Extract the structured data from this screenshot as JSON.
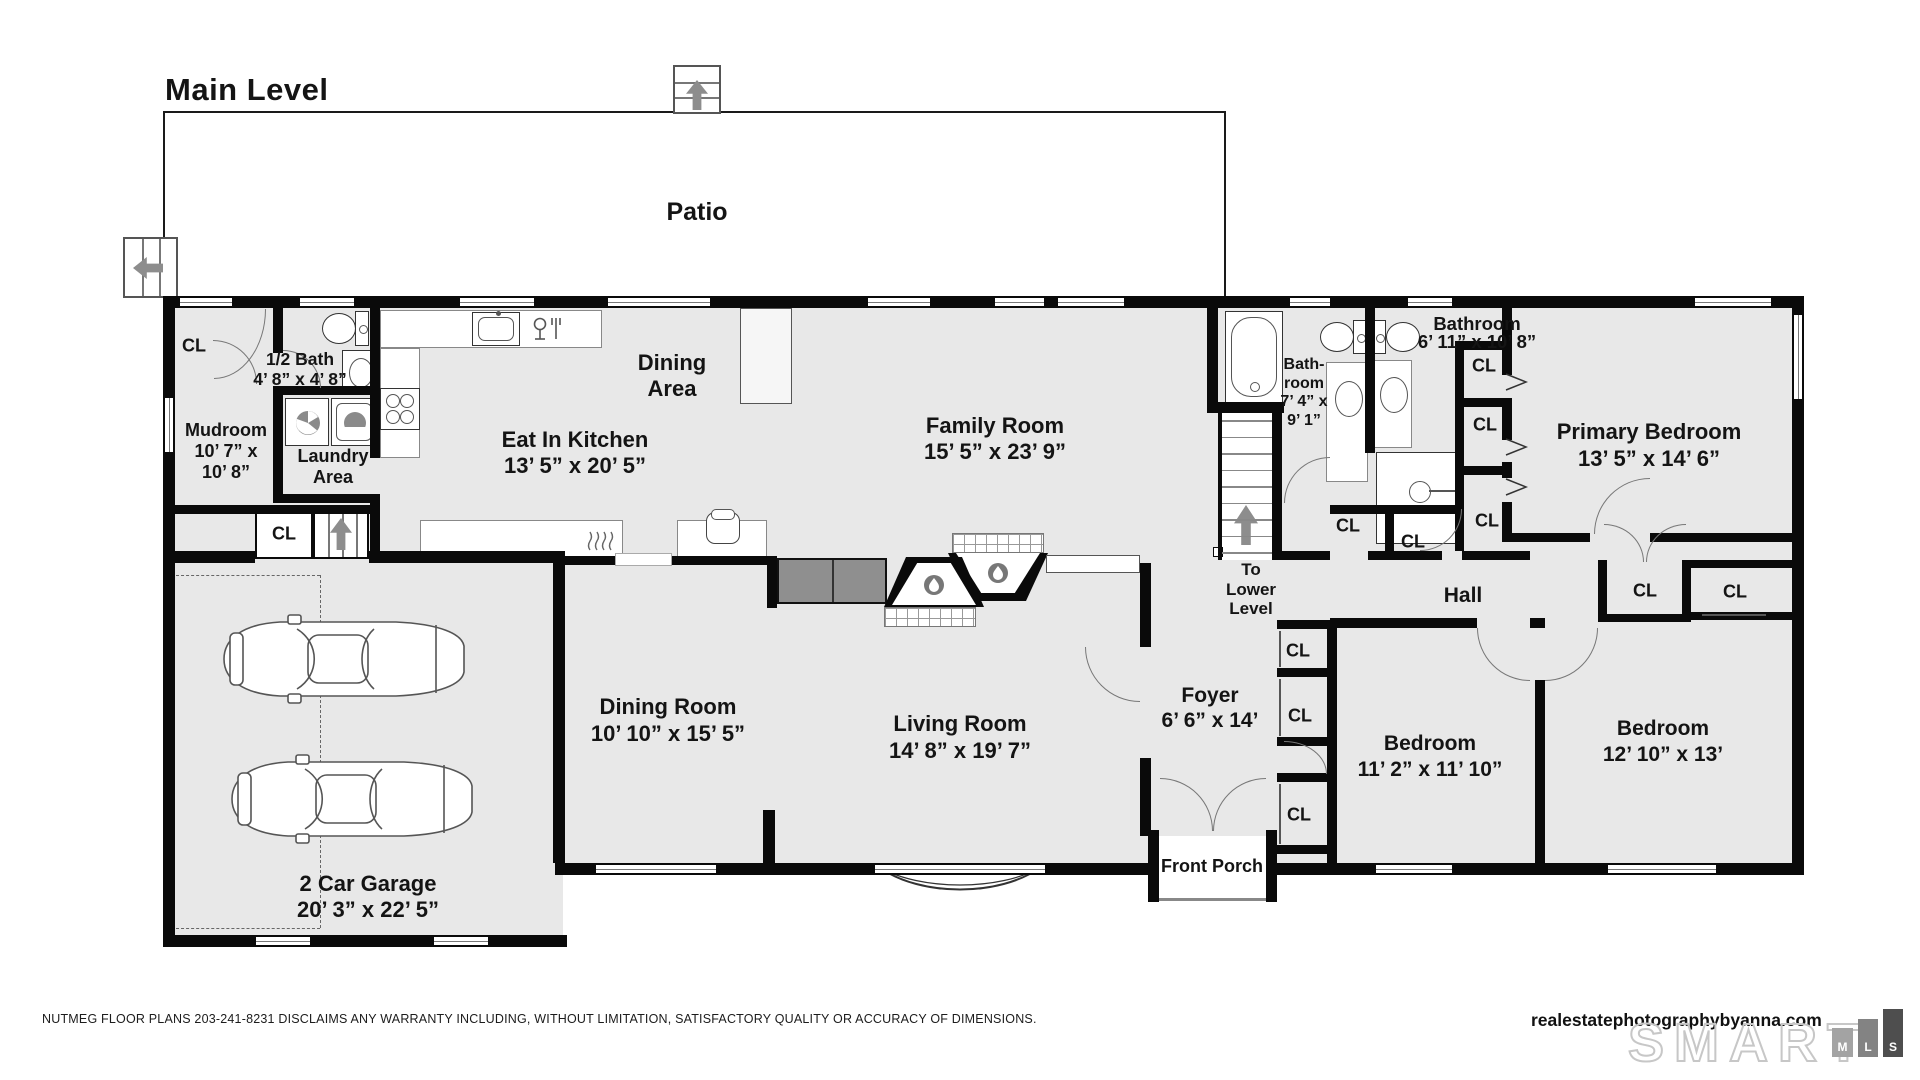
{
  "title": "Main Level",
  "patio": "Patio",
  "closet_label": "CL",
  "labels": [
    {
      "id": "kitchen",
      "lines": [
        "Eat In Kitchen",
        "13’ 5” x 20’ 5”"
      ]
    },
    {
      "id": "dining-area",
      "lines": [
        "Dining",
        "Area"
      ]
    },
    {
      "id": "family-room",
      "lines": [
        "Family Room",
        "15’ 5” x 23’ 9”"
      ]
    },
    {
      "id": "half-bath",
      "lines": [
        "1/2 Bath",
        "4’ 8” x 4’ 8”"
      ]
    },
    {
      "id": "mudroom",
      "lines": [
        "Mudroom",
        "10’ 7” x",
        "10’ 8”"
      ]
    },
    {
      "id": "laundry",
      "lines": [
        "Laundry",
        "Area"
      ]
    },
    {
      "id": "bath-1",
      "lines": [
        "Bath-",
        "room",
        "7’ 4” x",
        "9’ 1”"
      ]
    },
    {
      "id": "bath-2",
      "lines": [
        "Bathroom",
        "6’ 11” x 10’ 8”"
      ]
    },
    {
      "id": "primary-bedroom",
      "lines": [
        "Primary Bedroom",
        "13’ 5” x 14’ 6”"
      ]
    },
    {
      "id": "dining-room",
      "lines": [
        "Dining Room",
        "10’ 10” x 15’ 5”"
      ]
    },
    {
      "id": "living-room",
      "lines": [
        "Living Room",
        "14’ 8” x 19’ 7”"
      ]
    },
    {
      "id": "foyer",
      "lines": [
        "Foyer",
        "6’ 6” x 14’"
      ]
    },
    {
      "id": "bedroom-1",
      "lines": [
        "Bedroom",
        "11’ 2” x 11’ 10”"
      ]
    },
    {
      "id": "bedroom-2",
      "lines": [
        "Bedroom",
        "12’ 10” x 13’"
      ]
    },
    {
      "id": "garage",
      "lines": [
        "2 Car Garage",
        "20’ 3” x 22’ 5”"
      ]
    },
    {
      "id": "front-porch",
      "lines": [
        "Front Porch"
      ]
    },
    {
      "id": "hall",
      "lines": [
        "Hall"
      ]
    },
    {
      "id": "stairs-lower",
      "lines": [
        "To",
        "Lower",
        "Level"
      ]
    }
  ],
  "footer": {
    "disclaimer": "NUTMEG FLOOR PLANS 203-241-8231 DISCLAIMS ANY WARRANTY INCLUDING, WITHOUT LIMITATION, SATISFACTORY QUALITY OR ACCURACY OF DIMENSIONS.",
    "watermark": "realestatephotographybyanna.com",
    "brand_name": "SMART",
    "brand_letters": [
      "M",
      "L",
      "S"
    ]
  }
}
